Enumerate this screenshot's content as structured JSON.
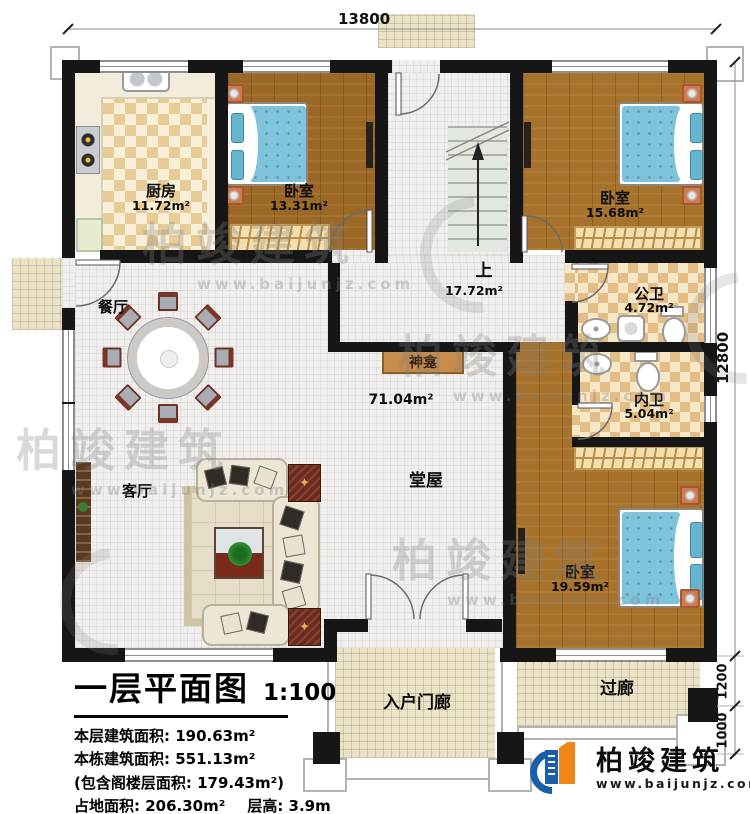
{
  "dimensions": {
    "top": "13800",
    "right": "12800",
    "lower_right_upper": "1200",
    "lower_right_lower": "1000"
  },
  "rooms": {
    "kitchen": {
      "name": "厨房",
      "area": "11.72m²"
    },
    "bedroom_nw": {
      "name": "卧室",
      "area": "13.31m²"
    },
    "bedroom_ne": {
      "name": "卧室",
      "area": "15.68m²"
    },
    "bedroom_se": {
      "name": "卧室",
      "area": "19.59m²"
    },
    "stairs": {
      "name": "上",
      "area": "17.72m²"
    },
    "public_bath": {
      "name": "公卫",
      "area": "4.72m²"
    },
    "private_bath": {
      "name": "内卫",
      "area": "5.04m²"
    },
    "hall": {
      "name": "堂屋",
      "area": "71.04m²"
    },
    "dining": {
      "name": "餐厅"
    },
    "living": {
      "name": "客厅"
    },
    "shrine": {
      "name": "神龛"
    },
    "entry_porch": {
      "name": "入户门廊"
    },
    "corridor": {
      "name": "过廊"
    }
  },
  "title_block": {
    "title": "一层平面图",
    "scale": "1:100",
    "stats": [
      "本层建筑面积: 190.63m²",
      "本栋建筑面积: 551.13m²",
      "(包含阁楼层面积: 179.43m²)"
    ],
    "stats_area": "占地面积: 206.30m²",
    "stats_height": "层高: 3.9m"
  },
  "logo": {
    "name": "柏竣建筑",
    "url": "www.baijunjz.com"
  },
  "watermark": {
    "text": "柏竣建筑",
    "url": "www.baijunjz.com"
  },
  "colors": {
    "wall": "#161616",
    "wood_floor": "#a6722c",
    "tile_floor": "#f0efed",
    "bath_checker": "#e3bd85",
    "bed_blue": "#7fc3da",
    "porch_tan": "#eae3c8",
    "logo_blue": "#1b5ea9",
    "logo_orange": "#f08519"
  }
}
